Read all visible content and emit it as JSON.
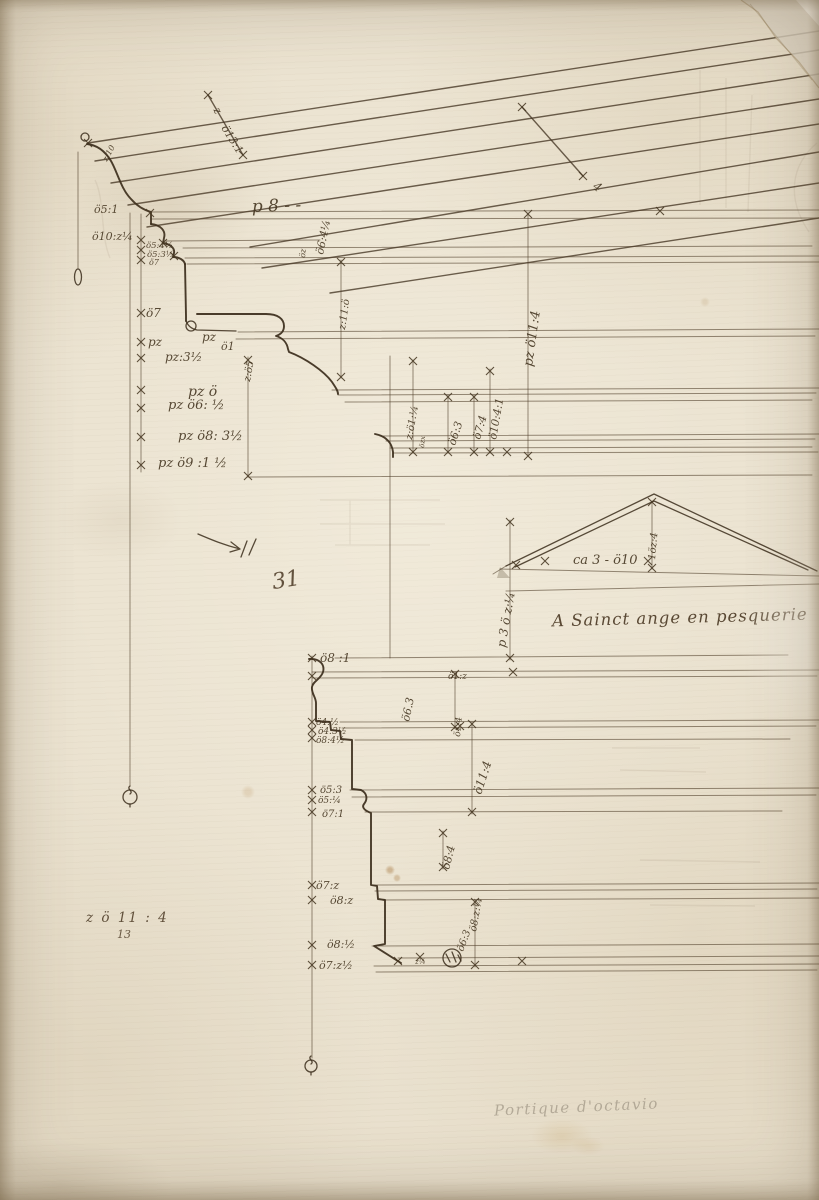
{
  "artwork": {
    "type": "architectural drawing, pen and brown ink on laid paper",
    "subject": "cornice and entablature profiles with raking cornice and pediment sketch"
  },
  "colors": {
    "paper": "#e8dfcc",
    "ink": "#42331e",
    "graphite": "#8a8070"
  },
  "inscriptions": {
    "main": "A Sainct ange en pesquerie",
    "page_number": "31",
    "graphite": "Portique d'octavio",
    "bottom_left": "z ö 11 : 4",
    "bottom_left_denominator": "13"
  },
  "annotations": [
    {
      "t": "z:10",
      "x": 107,
      "y": 162,
      "r": -62,
      "s": 8
    },
    {
      "t": "z",
      "x": 213,
      "y": 110,
      "r": 58,
      "s": 11
    },
    {
      "t": "ö13:1",
      "x": 221,
      "y": 128,
      "r": 58,
      "s": 11
    },
    {
      "t": "ö5:1",
      "x": 94,
      "y": 213,
      "r": 0,
      "s": 11
    },
    {
      "t": "ö10:z¼",
      "x": 92,
      "y": 240,
      "r": 0,
      "s": 11
    },
    {
      "t": "p 8 - -",
      "x": 252,
      "y": 212,
      "r": -2,
      "s": 17
    },
    {
      "t": "ö6:4¼",
      "x": 323,
      "y": 255,
      "r": -78,
      "s": 11
    },
    {
      "t": "öz",
      "x": 305,
      "y": 258,
      "r": -85,
      "s": 8
    },
    {
      "t": "ö5:4½",
      "x": 146,
      "y": 248,
      "r": 0,
      "s": 8.5
    },
    {
      "t": "ö5:3½",
      "x": 147,
      "y": 257,
      "r": 0,
      "s": 8.5
    },
    {
      "t": "ö7",
      "x": 149,
      "y": 265,
      "r": 0,
      "s": 8
    },
    {
      "t": "ö7",
      "x": 146,
      "y": 317,
      "r": 0,
      "s": 12
    },
    {
      "t": "pz",
      "x": 148,
      "y": 346,
      "r": 0,
      "s": 12
    },
    {
      "t": "pz",
      "x": 202,
      "y": 341,
      "r": 0,
      "s": 12
    },
    {
      "t": "ö1",
      "x": 221,
      "y": 350,
      "r": 0,
      "s": 11
    },
    {
      "t": "pz:3½",
      "x": 165,
      "y": 361,
      "r": 0,
      "s": 12
    },
    {
      "t": "z:ö5",
      "x": 250,
      "y": 382,
      "r": -80,
      "s": 10
    },
    {
      "t": "z:11:ö",
      "x": 345,
      "y": 330,
      "r": -82,
      "s": 10
    },
    {
      "t": "pz ö11:4",
      "x": 532,
      "y": 367,
      "r": -82,
      "s": 13
    },
    {
      "t": "pz ö",
      "x": 188,
      "y": 396,
      "r": 0,
      "s": 14
    },
    {
      "t": "pz ö6: ½",
      "x": 168,
      "y": 409,
      "r": 0,
      "s": 13
    },
    {
      "t": "pz ö8: 3½",
      "x": 178,
      "y": 440,
      "r": 0,
      "s": 13
    },
    {
      "t": "pz ö9 :1 ½",
      "x": 158,
      "y": 467,
      "r": 0,
      "s": 13
    },
    {
      "t": "z:ö1:¼",
      "x": 412,
      "y": 440,
      "r": -80,
      "s": 10
    },
    {
      "t": "özx",
      "x": 424,
      "y": 448,
      "r": -85,
      "s": 7
    },
    {
      "t": "ö6:3",
      "x": 455,
      "y": 446,
      "r": -72,
      "s": 11
    },
    {
      "t": "ö7:4",
      "x": 480,
      "y": 440,
      "r": -74,
      "s": 11
    },
    {
      "t": "ö10:4:1",
      "x": 496,
      "y": 440,
      "r": -80,
      "s": 11
    },
    {
      "t": "4",
      "x": 592,
      "y": 188,
      "r": 35,
      "s": 12
    },
    {
      "t": "ca 3 - ö10",
      "x": 573,
      "y": 564,
      "r": 0,
      "s": 13
    },
    {
      "t": "1öz:4",
      "x": 655,
      "y": 560,
      "r": -85,
      "s": 10
    },
    {
      "t": "p 3 ö z:¼",
      "x": 505,
      "y": 648,
      "r": -80,
      "s": 12
    },
    {
      "t": "ö8 :1",
      "x": 320,
      "y": 662,
      "r": 0,
      "s": 12
    },
    {
      "t": "ö1:z",
      "x": 448,
      "y": 679,
      "r": 0,
      "s": 9
    },
    {
      "t": "ö6.3",
      "x": 409,
      "y": 722,
      "r": -78,
      "s": 11
    },
    {
      "t": "ö4:½",
      "x": 316,
      "y": 725,
      "r": 0,
      "s": 9
    },
    {
      "t": "ö4:3½",
      "x": 318,
      "y": 734,
      "r": 0,
      "s": 9
    },
    {
      "t": "ö8:4½",
      "x": 316,
      "y": 743,
      "r": 0,
      "s": 9
    },
    {
      "t": "ö1:4",
      "x": 460,
      "y": 737,
      "r": -85,
      "s": 9
    },
    {
      "t": "ö11:4",
      "x": 481,
      "y": 795,
      "r": -72,
      "s": 12
    },
    {
      "t": "ö5:3",
      "x": 320,
      "y": 793,
      "r": 0,
      "s": 10
    },
    {
      "t": "ö5:¼",
      "x": 318,
      "y": 803,
      "r": 0,
      "s": 9
    },
    {
      "t": "ö7:1",
      "x": 322,
      "y": 817,
      "r": 0,
      "s": 10
    },
    {
      "t": "ö8:4",
      "x": 449,
      "y": 870,
      "r": -76,
      "s": 11
    },
    {
      "t": "ö7:z",
      "x": 316,
      "y": 889,
      "r": 0,
      "s": 11
    },
    {
      "t": "ö8:z",
      "x": 330,
      "y": 904,
      "r": 0,
      "s": 11
    },
    {
      "t": "ö8:z:¼",
      "x": 476,
      "y": 932,
      "r": -80,
      "s": 10
    },
    {
      "t": "ö6:3",
      "x": 463,
      "y": 952,
      "r": -70,
      "s": 10
    },
    {
      "t": "ö8:½",
      "x": 327,
      "y": 948,
      "r": 0,
      "s": 11
    },
    {
      "t": "ö7:z½",
      "x": 319,
      "y": 969,
      "r": 0,
      "s": 11
    },
    {
      "t": "z¼",
      "x": 415,
      "y": 964,
      "r": 0,
      "s": 7
    }
  ]
}
